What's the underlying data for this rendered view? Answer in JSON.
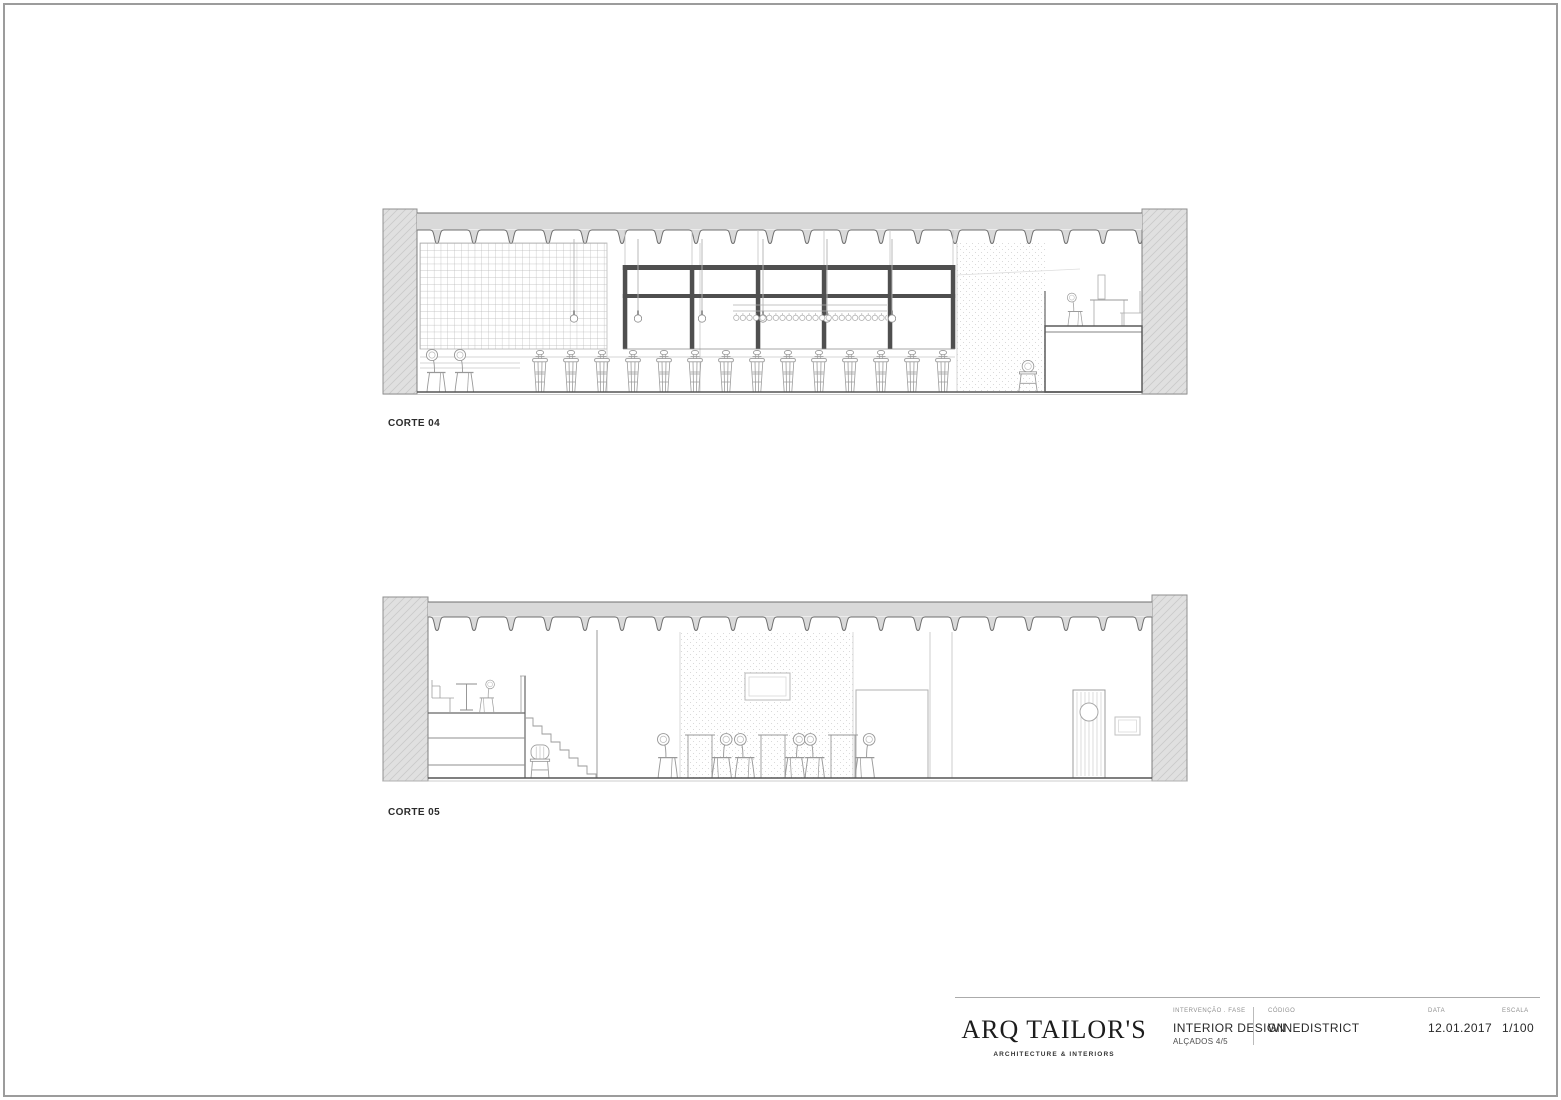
{
  "sheet": {
    "drawings": [
      {
        "label": "CORTE 04"
      },
      {
        "label": "CORTE 05"
      }
    ],
    "title_block": {
      "logo": {
        "name": "ARQ TAILOR'S",
        "subtitle": "ARCHITECTURE & INTERIORS"
      },
      "fields": [
        {
          "label": "INTERVENÇÃO . FASE",
          "value": "INTERIOR DESIGN",
          "extra": "ALÇADOS 4/5"
        },
        {
          "label": "CÓDIGO",
          "value": "WINEDISTRICT"
        },
        {
          "label": "DATA",
          "value": "12.01.2017"
        },
        {
          "label": "ESCALA",
          "value": "1/100"
        }
      ]
    },
    "colors": {
      "paper": "#ffffff",
      "sheet_border": "#9c9c9c",
      "wall_fill": "#e0e0e0",
      "ceiling_fill": "#d9d9d9",
      "outline_dark": "#5a5a5a",
      "glazing_frame": "#4f4f4f",
      "line_medium": "#9a9a9a",
      "text": "#2b2b2b"
    }
  }
}
